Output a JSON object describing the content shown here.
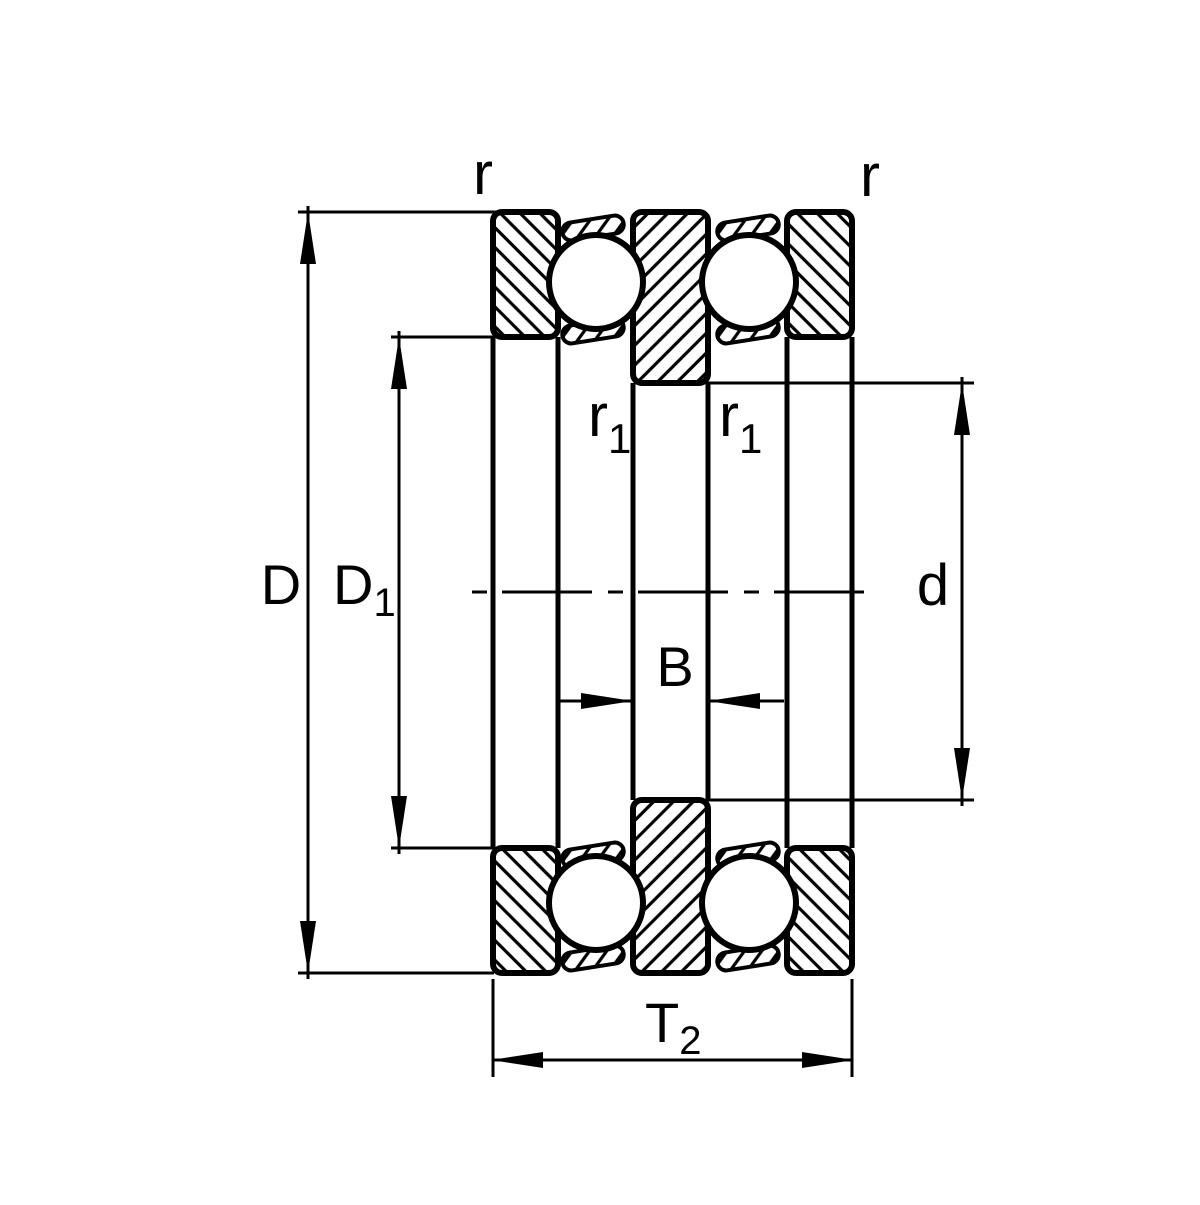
{
  "page": {
    "background_color": "#ffffff",
    "ink_color": "#000000"
  },
  "diagram": {
    "name": "thrust-ball-bearing-cross-section",
    "labels": {
      "outer_diameter": "D",
      "housing_washer_bore": {
        "main": "D",
        "sub": "1"
      },
      "bore_diameter": "d",
      "shaft_washer_width": "B",
      "bearing_height": {
        "main": "T",
        "sub": "2"
      },
      "chamfer_top_left": "r",
      "chamfer_top_right": "r",
      "chamfer_shaft_left": {
        "main": "r",
        "sub": "1"
      },
      "chamfer_shaft_right": {
        "main": "r",
        "sub": "1"
      }
    }
  }
}
